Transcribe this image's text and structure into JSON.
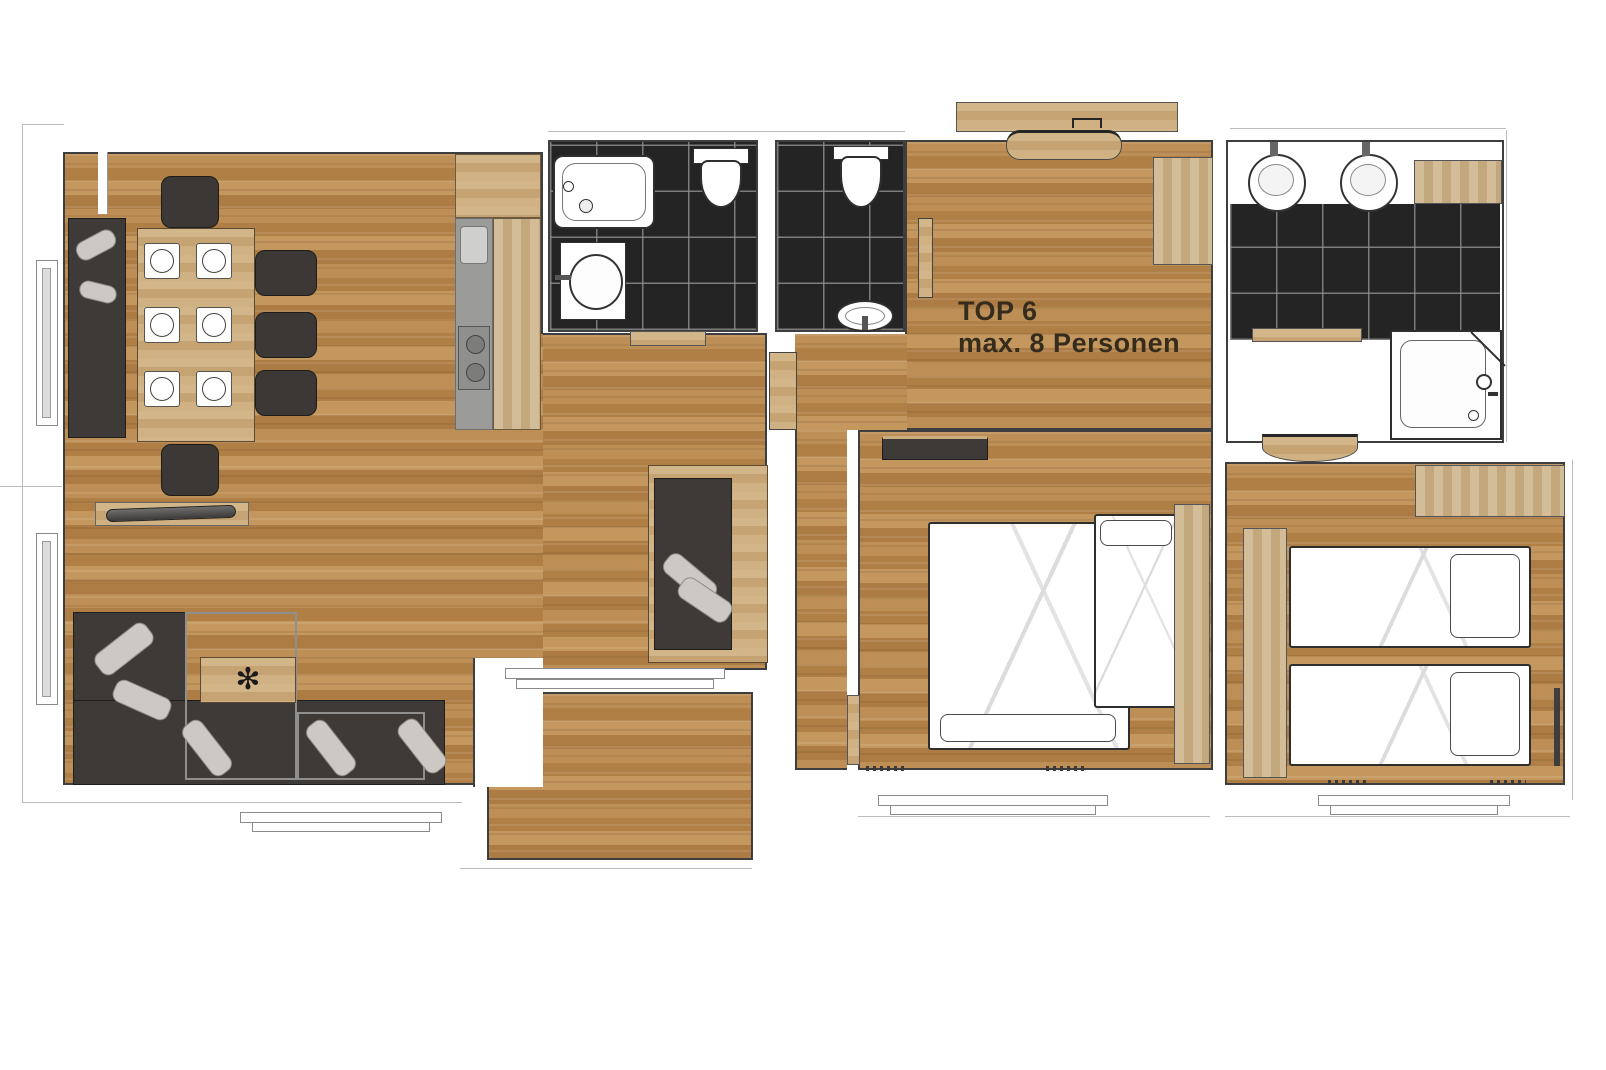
{
  "label": {
    "line1": "TOP 6",
    "line2": "max. 8 Personen"
  },
  "icons": {
    "plant_icon": "✻"
  },
  "palette": {
    "wood_floor": "#b9894f",
    "wood_furniture": "#cbad7e",
    "tile_dark": "#242424",
    "tile_grout": "#8c8c8c",
    "wall_outline": "#3e3e3e",
    "exterior_line": "#bcbcbc",
    "fixture_white": "#ffffff",
    "sofa_dark": "#3e3a37",
    "cushion_gray": "#ccc9c5",
    "counter_gray": "#9b9b99",
    "sill_gray": "#dcdcdc",
    "label_text": "#352c1d"
  }
}
